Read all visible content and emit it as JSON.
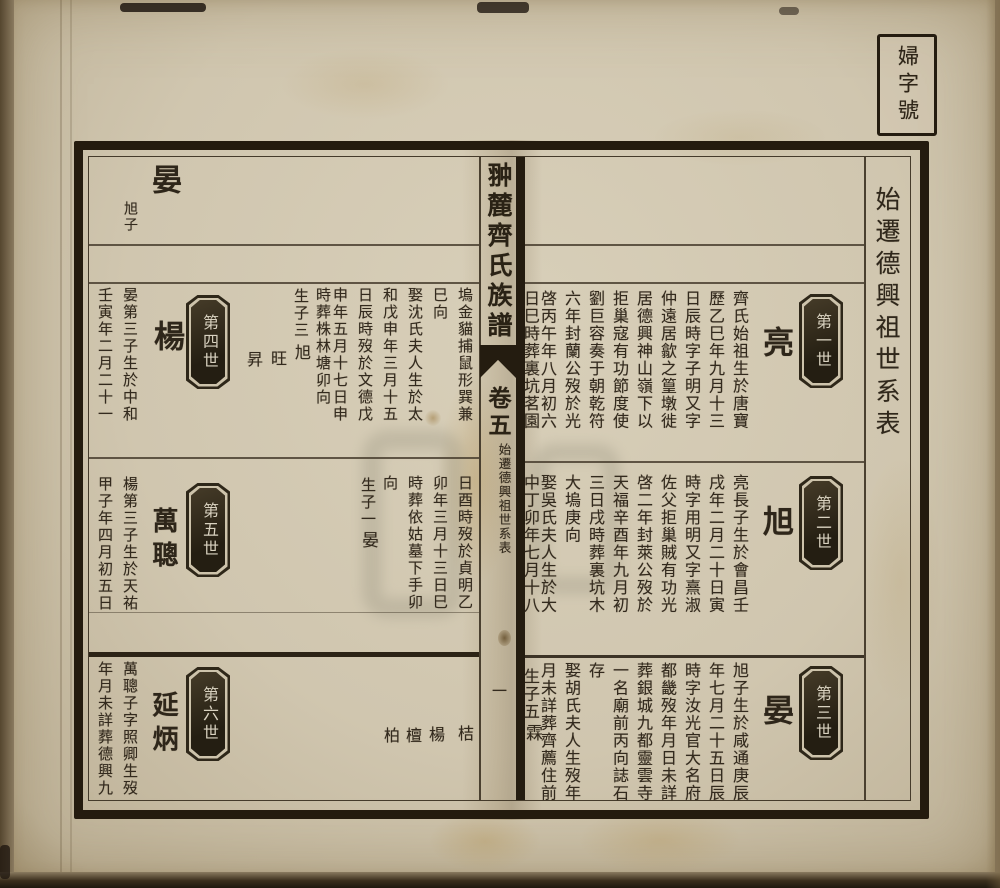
{
  "photo": {
    "label_box_text": "婦字號",
    "margin_title": "始遷德興祖世系表"
  },
  "spine": {
    "book_title": "翀麓齊氏族譜",
    "volume_label": "卷五",
    "section_title": "始遷德興祖世系表",
    "page_number": "一"
  },
  "right_page": {
    "band1": {
      "gen": "第一世",
      "name": "亮",
      "cols": [
        "齊氏始祖生於唐寶",
        "歷乙巳年九月十三",
        "日辰時字子明又字",
        "仲遠居歙之篁墩徙",
        "居德興神山嶺下以",
        "拒巢寇有功節度使",
        "劉巨容奏于朝乾符",
        "六年封蘭公歿於光",
        "啓丙午年八月初六",
        "日巳時葬裏坑茗園"
      ]
    },
    "band2": {
      "gen": "第二世",
      "name": "旭",
      "cols": [
        "亮長子生於會昌壬",
        "戌年二月二十日寅",
        "時字用明又字熹淑",
        "佐父拒巢賊有功光",
        "啓二年封萊公歿於",
        "天福辛酉年九月初",
        "三日戌時葬裏坑木",
        "大塢庚向",
        "娶吳氏夫人生於大",
        "中丁卯年七月十八"
      ]
    },
    "band3": {
      "gen": "第三世",
      "name": "晏",
      "cols": [
        "旭子生於咸通庚辰",
        "年七月二十五日辰",
        "時字汝光官大名府",
        "都畿歿年月日未詳",
        "葬銀城九都靈雲寺",
        "一名廟前丙向誌石",
        "存",
        "娶胡氏夫人生歿年",
        "月未詳葬齊薦住前",
        "生子五"
      ],
      "son": "霖"
    }
  },
  "left_page": {
    "header": {
      "name": "晏",
      "note": "旭子"
    },
    "band1": {
      "cont": [
        "塢金貓捕鼠形巽兼",
        "巳向",
        "娶沈氏夫人生於太",
        "和戊申年三月十五",
        "日辰時歿於文德戊",
        "申年五月十七日申",
        "時葬株林塘卯向",
        "生子三"
      ],
      "sons": [
        "旭",
        "旺",
        "昇"
      ],
      "gen": "第四世",
      "name": "楊",
      "bio": [
        "晏第三子生於中和",
        "壬寅年二月二十一"
      ]
    },
    "band2": {
      "cont": [
        "日酉時歿於貞明乙",
        "卯年三月十三日巳",
        "時葬依姑墓下手卯",
        "向",
        "生子一"
      ],
      "son": "晏",
      "gen": "第五世",
      "name": "萬聰",
      "bio": [
        "楊第三子生於天祐",
        "甲子年四月初五日"
      ]
    },
    "band3": {
      "sons": [
        "桔",
        "楊",
        "檀",
        "柏"
      ],
      "gen": "第六世",
      "name": "延炳",
      "bio": [
        "萬聰子字照卿生歿",
        "年月未詳葬德興九"
      ]
    }
  }
}
